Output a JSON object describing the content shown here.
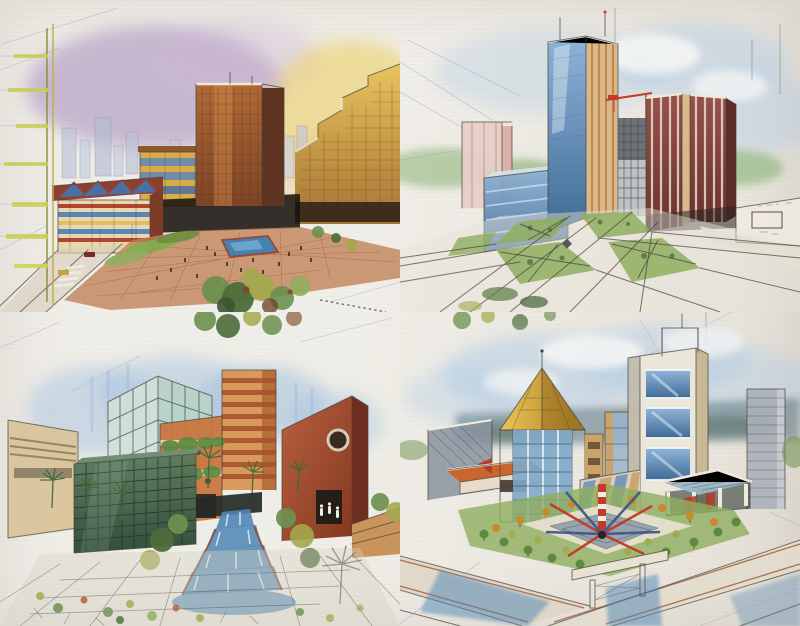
{
  "page": {
    "kind": "scanned book page",
    "description": "Four hand-rendered architectural marker sketches of urban developments arranged in a two-by-two grid on off-white paper with faint pencil construction lines",
    "background": "#efede7"
  },
  "palette": {
    "ink": "#46413a",
    "pencil": "#a49fb4",
    "skyViolet": "#a284b8",
    "skyAmber": "#eecf5e",
    "skyBlue": "#aecbe6",
    "cloudWhite": "#f6f7f5",
    "towerBrown": "#a35c30",
    "goldFacade": "#d9a83f",
    "glassBlue": "#6f9cc9",
    "maroon": "#8e4a44",
    "terracotta": "#c9763f",
    "brickPlaza": "#c08055",
    "lawnGreen": "#8fae5f",
    "foliage": "#6d8f4e",
    "oliveFoliage": "#a3a94f",
    "waterBlue": "#4f86b5",
    "pinkSlab": "#e8cdc6",
    "greenGlassDark": "#4f6f52",
    "roofGold": "#dcaf3c",
    "redAccent": "#c23b2a",
    "paleStone": "#eae6da"
  },
  "panels": [
    {
      "id": "sunset-plaza",
      "position": "top-left",
      "description": "Downtown plaza at dusk: violet-to-amber marker sky, brown high-rise tower, stepped gold office block, sawtooth-roof pavilion, terracotta paved plaza with blue pool, street and shrubs in foreground, yellow-green light pole at left edge",
      "elements": [
        "violet-amber sky wash",
        "background skyline",
        "central brown tower",
        "stepped gold building",
        "gold mid-rise",
        "sawtooth pavilion",
        "terracotta plaza",
        "blue pool",
        "hedges and crowd dots",
        "foreground street with crosswalk",
        "shrub cluster",
        "tick-bar pole"
      ]
    },
    {
      "id": "office-park-aerial",
      "position": "top-right",
      "description": "Aerial view of an office park: blue-glass tower with tan piers, twin maroon towers, building under construction with red crane, pale pink slab, blue glass block, lawns with crossing diagonal paths, white rooftops at right",
      "elements": [
        "pale blue sky",
        "tree band",
        "pink slab tower",
        "blue glass block",
        "blue-and-tan tower",
        "construction frame and red crane",
        "maroon twin towers",
        "white rooftop planes",
        "lawn quadrants with X paths",
        "radiating roads"
      ]
    },
    {
      "id": "courtyard-fountain",
      "position": "bottom-left",
      "description": "Retail courtyard: blue wash backdrop, gridded glass cube, dark green glass box, banded terracotta tower with hanging vines, red gabled building with round window, palm trees and a stepped cascade fountain flowing toward the viewer",
      "elements": [
        "blue backdrop wash",
        "tan building edge",
        "glass grid cube",
        "dark green glass cube",
        "banded terracotta tower",
        "vine ledges",
        "red gabled building",
        "round window",
        "cascade fountain",
        "palms",
        "paving and plant speckles"
      ]
    },
    {
      "id": "civic-center-plaza",
      "position": "bottom-right",
      "description": "Civic center: gold pyramid-roof tower, white tower with blue glass panels, diagonal striped wing, glass pavilion with red accents, tree-ringed garden with red and blue sculpture, crossing roads and water below",
      "elements": [
        "blue sky and clouds",
        "blue-green ridge",
        "grey wall",
        "terracotta shed",
        "pyramid-roof tower",
        "white glass tower",
        "striped wing",
        "glass pavilion",
        "garden tree rings",
        "spike sculpture",
        "roads and overpass",
        "water patches"
      ]
    }
  ]
}
